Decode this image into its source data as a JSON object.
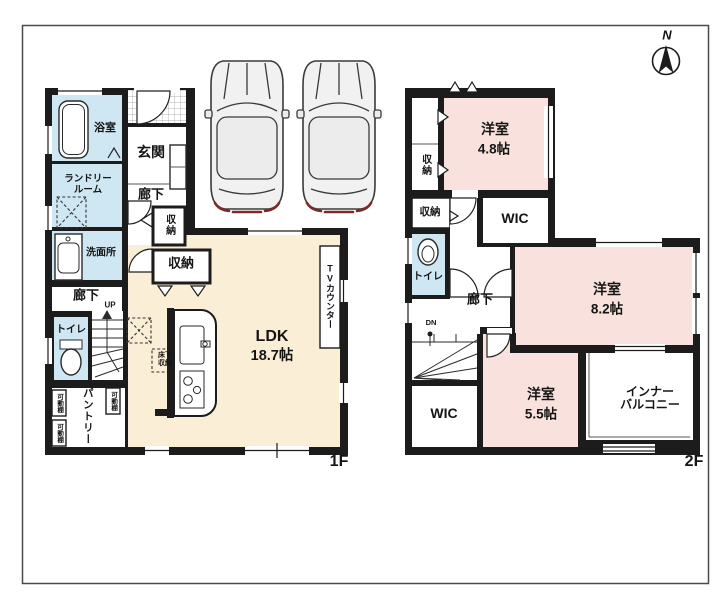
{
  "compass": {
    "north": "N"
  },
  "colors": {
    "wall": "#1c1c1c",
    "pink": "#f9e2dd",
    "cream": "#fbeed6",
    "blue": "#cfe7f2"
  },
  "floor1": {
    "floor_label": "1F",
    "bath": "浴室",
    "laundry_l1": "ランドリー",
    "laundry_l2": "ルーム",
    "entrance": "玄関",
    "hall_upper": "廊下",
    "washroom": "洗面所",
    "closet_hall": "収納",
    "closet_ldk": "収納",
    "hall_lower": "廊下",
    "up": "UP",
    "toilet": "トイレ",
    "pantry": "パントリー",
    "shelf_a": "可動棚",
    "shelf_b": "可動棚",
    "shelf_c": "可動棚",
    "underfloor_l1": "床下",
    "underfloor_l2": "収納",
    "ldk_name": "LDK",
    "ldk_size": "18.7帖",
    "tv_counter": "TVカウンター"
  },
  "floor2": {
    "floor_label": "2F",
    "closet_a": "収納",
    "room48_name": "洋室",
    "room48_size": "4.8帖",
    "closet_b": "収納",
    "wic_upper": "WIC",
    "toilet": "トイレ",
    "hall": "廊下",
    "dn": "DN",
    "wic_lower": "WIC",
    "room55_name": "洋室",
    "room55_size": "5.5帖",
    "room82_name": "洋室",
    "room82_size": "8.2帖",
    "balcony_l1": "インナー",
    "balcony_l2": "バルコニー"
  }
}
